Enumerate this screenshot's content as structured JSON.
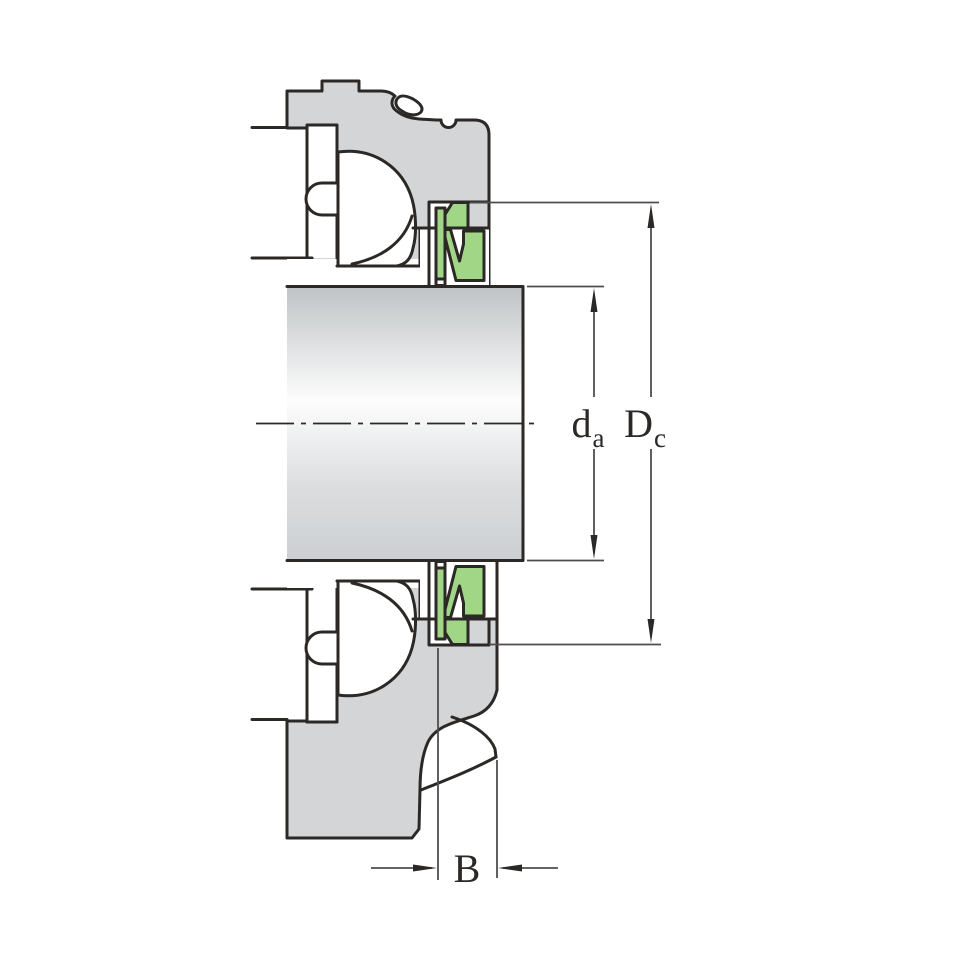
{
  "figure": {
    "labels": {
      "da": {
        "main": "d",
        "sub": "a"
      },
      "Dc": {
        "main": "D",
        "sub": "c"
      },
      "B": {
        "main": "B"
      }
    },
    "colors": {
      "outline": "#2b2826",
      "housing_fill": "#d3d5d6",
      "seal_fill": "#a2d687",
      "dimension_line": "#4d4e50",
      "background": "#ffffff"
    },
    "shaft_gradient": [
      "#bfc3c5",
      "#fdfdfd",
      "#dcdee0",
      "#cccfd1"
    ]
  }
}
